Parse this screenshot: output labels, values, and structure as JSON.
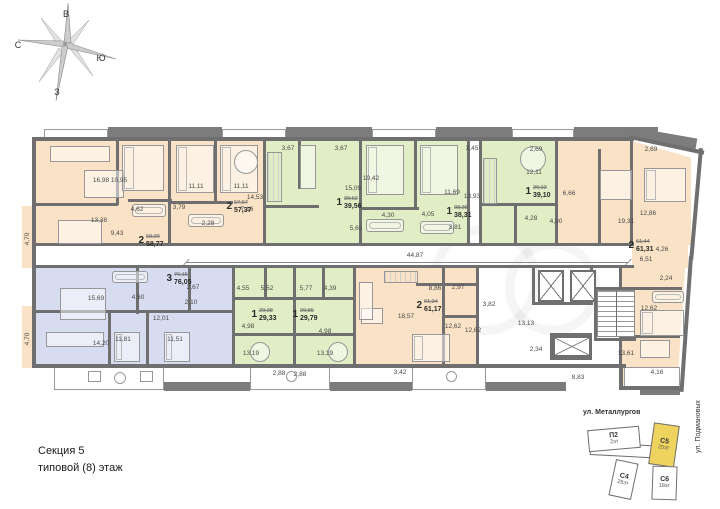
{
  "compass": {
    "east": "В",
    "north": "С",
    "south": "Ю",
    "west": "З"
  },
  "footer": {
    "line1": "Секция 5",
    "line2": "типовой (8) этаж"
  },
  "corridor": {
    "dim": "44,87"
  },
  "palette": {
    "wall": "#6f6f6f",
    "peach": "#f9e2c5",
    "green": "#e1edc5",
    "blue": "#d7dcf0",
    "highlight": "#eed45f"
  },
  "minimap": {
    "street_top": "ул. Металлургов",
    "street_right": "ул. Подмановых",
    "buildings": [
      {
        "name": "П2",
        "floors": "2эт",
        "x": 588,
        "y": 428,
        "w": 52,
        "h": 22,
        "rot": -5,
        "highlight": false
      },
      {
        "name": "С4",
        "floors": "25эт",
        "x": 612,
        "y": 461,
        "w": 23,
        "h": 37,
        "rot": 12,
        "highlight": false
      },
      {
        "name": "С5",
        "floors": "25эт",
        "x": 651,
        "y": 424,
        "w": 26,
        "h": 42,
        "rot": 8,
        "highlight": true
      },
      {
        "name": "С6",
        "floors": "18эт",
        "x": 652,
        "y": 466,
        "w": 25,
        "h": 34,
        "rot": 2,
        "highlight": false
      }
    ],
    "connector": {
      "x": 590,
      "y": 444,
      "w": 76,
      "h": 13,
      "rot": 3
    }
  },
  "plan": {
    "regions": [
      {
        "c": "peach",
        "x": 34,
        "y": 141,
        "w": 136,
        "h": 104
      },
      {
        "c": "peach",
        "x": 170,
        "y": 141,
        "w": 95,
        "h": 104
      },
      {
        "c": "green",
        "x": 265,
        "y": 141,
        "w": 96,
        "h": 104
      },
      {
        "c": "green",
        "x": 361,
        "y": 141,
        "w": 108,
        "h": 104
      },
      {
        "c": "green",
        "x": 481,
        "y": 141,
        "w": 76,
        "h": 104
      },
      {
        "c": "peach",
        "x": 557,
        "y": 141,
        "w": 134,
        "h": 104,
        "clip": "polygon(0 0,56% 0,100% 16%,100% 100%,0 100%)"
      },
      {
        "c": "peach",
        "x": 632,
        "y": 245,
        "w": 56,
        "h": 23
      },
      {
        "c": "blue",
        "x": 34,
        "y": 268,
        "w": 200,
        "h": 96
      },
      {
        "c": "green",
        "x": 234,
        "y": 268,
        "w": 61,
        "h": 96
      },
      {
        "c": "green",
        "x": 295,
        "y": 268,
        "w": 60,
        "h": 96
      },
      {
        "c": "peach",
        "x": 355,
        "y": 268,
        "w": 123,
        "h": 96
      },
      {
        "c": "peach",
        "x": 621,
        "y": 268,
        "w": 64,
        "h": 118,
        "clip": "polygon(0 0,100% 0,88% 100%,0 100%)"
      },
      {
        "c": "peach",
        "x": 22,
        "y": 206,
        "w": 12,
        "h": 62
      },
      {
        "c": "peach",
        "x": 22,
        "y": 306,
        "w": 12,
        "h": 62
      }
    ],
    "walls": [
      [
        32,
        137,
        602,
        4
      ],
      [
        630,
        135,
        76,
        4,
        12
      ],
      [
        699,
        148,
        4,
        112,
        5
      ],
      [
        689,
        256,
        4,
        136,
        4
      ],
      [
        32,
        364,
        450,
        4
      ],
      [
        478,
        364,
        148,
        4
      ],
      [
        619,
        364,
        4,
        26
      ],
      [
        619,
        386,
        60,
        4
      ],
      [
        32,
        137,
        4,
        231
      ],
      [
        34,
        243,
        600,
        3
      ],
      [
        34,
        265,
        600,
        3
      ],
      [
        168,
        141,
        3,
        102
      ],
      [
        263,
        141,
        3,
        102
      ],
      [
        359,
        141,
        3,
        102
      ],
      [
        467,
        141,
        3,
        102
      ],
      [
        479,
        141,
        3,
        102
      ],
      [
        555,
        141,
        3,
        102
      ],
      [
        630,
        141,
        3,
        104
      ],
      [
        232,
        268,
        3,
        96
      ],
      [
        293,
        268,
        3,
        96
      ],
      [
        353,
        268,
        3,
        96
      ],
      [
        476,
        268,
        3,
        96
      ],
      [
        619,
        268,
        3,
        96
      ],
      [
        34,
        203,
        84,
        3
      ],
      [
        116,
        141,
        3,
        64
      ],
      [
        128,
        199,
        44,
        3
      ],
      [
        214,
        141,
        3,
        60
      ],
      [
        171,
        201,
        62,
        3
      ],
      [
        298,
        141,
        3,
        48
      ],
      [
        265,
        205,
        54,
        3
      ],
      [
        361,
        207,
        58,
        3
      ],
      [
        414,
        141,
        3,
        68
      ],
      [
        481,
        203,
        76,
        3
      ],
      [
        514,
        206,
        3,
        38
      ],
      [
        598,
        149,
        3,
        96
      ],
      [
        136,
        268,
        3,
        46
      ],
      [
        34,
        310,
        200,
        3
      ],
      [
        108,
        313,
        3,
        51
      ],
      [
        146,
        313,
        3,
        51
      ],
      [
        188,
        268,
        3,
        44
      ],
      [
        234,
        297,
        120,
        3
      ],
      [
        234,
        333,
        120,
        3
      ],
      [
        264,
        268,
        3,
        31
      ],
      [
        322,
        268,
        3,
        31
      ],
      [
        442,
        268,
        3,
        96
      ],
      [
        442,
        315,
        36,
        3
      ],
      [
        416,
        283,
        62,
        3
      ],
      [
        532,
        268,
        3,
        37
      ],
      [
        590,
        268,
        3,
        37
      ],
      [
        532,
        302,
        61,
        3
      ],
      [
        594,
        287,
        42,
        3
      ],
      [
        594,
        287,
        3,
        54
      ],
      [
        594,
        338,
        42,
        3
      ],
      [
        550,
        333,
        42,
        3
      ],
      [
        550,
        333,
        3,
        27
      ],
      [
        589,
        333,
        3,
        27
      ],
      [
        550,
        357,
        42,
        3
      ],
      [
        622,
        287,
        60,
        3
      ],
      [
        622,
        335,
        58,
        3
      ]
    ],
    "balconies_white": [
      [
        44,
        129,
        64,
        11
      ],
      [
        222,
        129,
        64,
        11
      ],
      [
        372,
        129,
        64,
        11
      ],
      [
        512,
        129,
        62,
        11
      ],
      [
        54,
        366,
        110,
        24
      ],
      [
        250,
        366,
        80,
        24
      ],
      [
        412,
        366,
        74,
        24
      ],
      [
        624,
        367,
        56,
        21
      ]
    ],
    "balconies_dark": [
      [
        108,
        127,
        114,
        13
      ],
      [
        286,
        127,
        86,
        13
      ],
      [
        436,
        127,
        76,
        13
      ],
      [
        574,
        127,
        84,
        13
      ],
      [
        654,
        131,
        44,
        13,
        10
      ],
      [
        164,
        382,
        86,
        9
      ],
      [
        330,
        382,
        82,
        9
      ],
      [
        486,
        382,
        80,
        9
      ],
      [
        640,
        387,
        40,
        8
      ]
    ],
    "room_labels": [
      {
        "t": "16,98",
        "x": 101,
        "y": 181
      },
      {
        "t": "10,95",
        "x": 119,
        "y": 181
      },
      {
        "t": "11,11",
        "x": 196,
        "y": 187
      },
      {
        "t": "11,11",
        "x": 241,
        "y": 187
      },
      {
        "t": "14,53",
        "x": 255,
        "y": 198
      },
      {
        "t": "13,38",
        "x": 99,
        "y": 221
      },
      {
        "t": "9,43",
        "x": 117,
        "y": 234
      },
      {
        "t": "4,62",
        "x": 137,
        "y": 210
      },
      {
        "t": "3,79",
        "x": 179,
        "y": 208
      },
      {
        "t": "2,28",
        "x": 208,
        "y": 224
      },
      {
        "t": "7,16",
        "x": 247,
        "y": 210
      },
      {
        "t": "3,67",
        "x": 288,
        "y": 149
      },
      {
        "t": "3,67",
        "x": 341,
        "y": 149
      },
      {
        "t": "3,45",
        "x": 472,
        "y": 149
      },
      {
        "t": "10,42",
        "x": 371,
        "y": 179
      },
      {
        "t": "15,09",
        "x": 353,
        "y": 189
      },
      {
        "t": "5,65",
        "x": 356,
        "y": 229
      },
      {
        "t": "4,30",
        "x": 388,
        "y": 216
      },
      {
        "t": "4,05",
        "x": 428,
        "y": 215
      },
      {
        "t": "11,69",
        "x": 452,
        "y": 193
      },
      {
        "t": "13,93",
        "x": 472,
        "y": 197
      },
      {
        "t": "3,81",
        "x": 455,
        "y": 228
      },
      {
        "t": "2,69",
        "x": 536,
        "y": 150
      },
      {
        "t": "12,11",
        "x": 534,
        "y": 173
      },
      {
        "t": "6,66",
        "x": 569,
        "y": 194
      },
      {
        "t": "4,28",
        "x": 531,
        "y": 219
      },
      {
        "t": "4,90",
        "x": 556,
        "y": 222
      },
      {
        "t": "2,69",
        "x": 651,
        "y": 150
      },
      {
        "t": "19,31",
        "x": 626,
        "y": 222
      },
      {
        "t": "12,86",
        "x": 648,
        "y": 214
      },
      {
        "t": "4,26",
        "x": 662,
        "y": 250
      },
      {
        "t": "6,51",
        "x": 646,
        "y": 260
      },
      {
        "t": "2,24",
        "x": 666,
        "y": 279
      },
      {
        "t": "12,62",
        "x": 649,
        "y": 309
      },
      {
        "t": "4,16",
        "x": 657,
        "y": 373
      },
      {
        "t": "4,70",
        "x": 28,
        "y": 239,
        "r": -90
      },
      {
        "t": "4,70",
        "x": 28,
        "y": 339,
        "r": -90
      },
      {
        "t": "15,69",
        "x": 96,
        "y": 299
      },
      {
        "t": "4,60",
        "x": 138,
        "y": 298
      },
      {
        "t": "2,67",
        "x": 193,
        "y": 288
      },
      {
        "t": "2,10",
        "x": 191,
        "y": 303
      },
      {
        "t": "12,01",
        "x": 161,
        "y": 319
      },
      {
        "t": "14,20",
        "x": 101,
        "y": 344
      },
      {
        "t": "11,81",
        "x": 123,
        "y": 340
      },
      {
        "t": "11,51",
        "x": 175,
        "y": 340
      },
      {
        "t": "4,55",
        "x": 243,
        "y": 289
      },
      {
        "t": "4,98",
        "x": 248,
        "y": 327
      },
      {
        "t": "13,19",
        "x": 251,
        "y": 354
      },
      {
        "t": "5,52",
        "x": 267,
        "y": 289
      },
      {
        "t": "5,77",
        "x": 306,
        "y": 289
      },
      {
        "t": "4,39",
        "x": 330,
        "y": 289
      },
      {
        "t": "4,98",
        "x": 325,
        "y": 332
      },
      {
        "t": "13,19",
        "x": 325,
        "y": 354
      },
      {
        "t": "2,88",
        "x": 279,
        "y": 374
      },
      {
        "t": "2,88",
        "x": 300,
        "y": 375
      },
      {
        "t": "8,86",
        "x": 435,
        "y": 289
      },
      {
        "t": "2,97",
        "x": 458,
        "y": 288
      },
      {
        "t": "18,57",
        "x": 406,
        "y": 317
      },
      {
        "t": "12,62",
        "x": 453,
        "y": 327
      },
      {
        "t": "12,62",
        "x": 473,
        "y": 331
      },
      {
        "t": "3,42",
        "x": 400,
        "y": 373
      },
      {
        "t": "3,82",
        "x": 489,
        "y": 305
      },
      {
        "t": "13,13",
        "x": 526,
        "y": 324
      },
      {
        "t": "2,34",
        "x": 536,
        "y": 350
      },
      {
        "t": "8,83",
        "x": 578,
        "y": 378
      },
      {
        "t": "13,61",
        "x": 626,
        "y": 354
      }
    ],
    "apt_labels": [
      {
        "n": "2",
        "old": "58,39",
        "area": "58,77",
        "x": 151,
        "y": 241
      },
      {
        "n": "2",
        "old": "57,57",
        "area": "57,37",
        "x": 239,
        "y": 207
      },
      {
        "n": "1",
        "old": "39,62",
        "area": "39,56",
        "x": 349,
        "y": 203
      },
      {
        "n": "1",
        "old": "38,38",
        "area": "38,31",
        "x": 459,
        "y": 212
      },
      {
        "n": "1",
        "old": "39,13",
        "area": "39,10",
        "x": 538,
        "y": 192
      },
      {
        "n": "2",
        "old": "61,44",
        "area": "61,31",
        "x": 641,
        "y": 246
      },
      {
        "n": "3",
        "old": "76,15",
        "area": "76,05",
        "x": 179,
        "y": 279
      },
      {
        "n": "1",
        "old": "29,38",
        "area": "29,33",
        "x": 264,
        "y": 315
      },
      {
        "n": "1",
        "old": "29,85",
        "area": "29,79",
        "x": 305,
        "y": 315
      },
      {
        "n": "2",
        "old": "61,34",
        "area": "61,17",
        "x": 429,
        "y": 306
      }
    ],
    "furniture": [
      {
        "k": "sofa",
        "x": 50,
        "y": 146,
        "w": 60,
        "h": 16
      },
      {
        "k": "table",
        "x": 84,
        "y": 170,
        "w": 40,
        "h": 28
      },
      {
        "k": "bed",
        "x": 122,
        "y": 145,
        "w": 42,
        "h": 46
      },
      {
        "k": "desk",
        "x": 58,
        "y": 220,
        "w": 44,
        "h": 24
      },
      {
        "k": "bed",
        "x": 176,
        "y": 145,
        "w": 38,
        "h": 48
      },
      {
        "k": "bed",
        "x": 220,
        "y": 145,
        "w": 38,
        "h": 48
      },
      {
        "k": "tub",
        "x": 132,
        "y": 204,
        "w": 34,
        "h": 13
      },
      {
        "k": "tub",
        "x": 188,
        "y": 214,
        "w": 36,
        "h": 13
      },
      {
        "k": "circle",
        "x": 234,
        "y": 150,
        "w": 24,
        "h": 24
      },
      {
        "k": "counter",
        "x": 267,
        "y": 152,
        "w": 15,
        "h": 50
      },
      {
        "k": "sofa",
        "x": 300,
        "y": 145,
        "w": 16,
        "h": 44
      },
      {
        "k": "bed",
        "x": 366,
        "y": 145,
        "w": 38,
        "h": 50
      },
      {
        "k": "bed",
        "x": 420,
        "y": 145,
        "w": 38,
        "h": 50
      },
      {
        "k": "tub",
        "x": 366,
        "y": 219,
        "w": 38,
        "h": 13
      },
      {
        "k": "tub",
        "x": 420,
        "y": 221,
        "w": 34,
        "h": 13
      },
      {
        "k": "circle",
        "x": 520,
        "y": 146,
        "w": 26,
        "h": 26
      },
      {
        "k": "counter",
        "x": 483,
        "y": 158,
        "w": 14,
        "h": 46
      },
      {
        "k": "table",
        "x": 600,
        "y": 170,
        "w": 32,
        "h": 30
      },
      {
        "k": "bed",
        "x": 644,
        "y": 168,
        "w": 42,
        "h": 34
      },
      {
        "k": "tub",
        "x": 652,
        "y": 291,
        "w": 32,
        "h": 12
      },
      {
        "k": "bed",
        "x": 640,
        "y": 310,
        "w": 44,
        "h": 26
      },
      {
        "k": "desk",
        "x": 640,
        "y": 340,
        "w": 30,
        "h": 18
      },
      {
        "k": "table",
        "x": 60,
        "y": 288,
        "w": 46,
        "h": 32
      },
      {
        "k": "sofa",
        "x": 46,
        "y": 332,
        "w": 58,
        "h": 15
      },
      {
        "k": "bed",
        "x": 114,
        "y": 332,
        "w": 26,
        "h": 30
      },
      {
        "k": "bed",
        "x": 164,
        "y": 332,
        "w": 26,
        "h": 30
      },
      {
        "k": "tub",
        "x": 112,
        "y": 271,
        "w": 36,
        "h": 12
      },
      {
        "k": "circle",
        "x": 250,
        "y": 342,
        "w": 20,
        "h": 20
      },
      {
        "k": "circle",
        "x": 328,
        "y": 342,
        "w": 20,
        "h": 20
      },
      {
        "k": "counter",
        "x": 384,
        "y": 271,
        "w": 34,
        "h": 12
      },
      {
        "k": "table",
        "x": 361,
        "y": 308,
        "w": 22,
        "h": 16
      },
      {
        "k": "bed",
        "x": 412,
        "y": 334,
        "w": 38,
        "h": 28
      },
      {
        "k": "sofa",
        "x": 359,
        "y": 282,
        "w": 14,
        "h": 38
      },
      {
        "k": "chair",
        "x": 88,
        "y": 371,
        "w": 13,
        "h": 11
      },
      {
        "k": "chair",
        "x": 140,
        "y": 371,
        "w": 13,
        "h": 11
      },
      {
        "k": "circle",
        "x": 114,
        "y": 372,
        "w": 12,
        "h": 12
      },
      {
        "k": "circle",
        "x": 286,
        "y": 371,
        "w": 11,
        "h": 11
      },
      {
        "k": "circle",
        "x": 446,
        "y": 371,
        "w": 11,
        "h": 11
      }
    ],
    "elevators": [
      [
        538,
        270,
        26,
        32
      ],
      [
        570,
        270,
        26,
        32
      ],
      [
        553,
        336,
        38,
        21
      ]
    ],
    "stairs": [
      597,
      290,
      38,
      47
    ],
    "dim": {
      "x1": 186,
      "x2": 628,
      "y": 262,
      "lx": 415,
      "ly": 256
    },
    "watermarks": [
      [
        430,
        225,
        110
      ],
      [
        505,
        240,
        95
      ]
    ]
  }
}
